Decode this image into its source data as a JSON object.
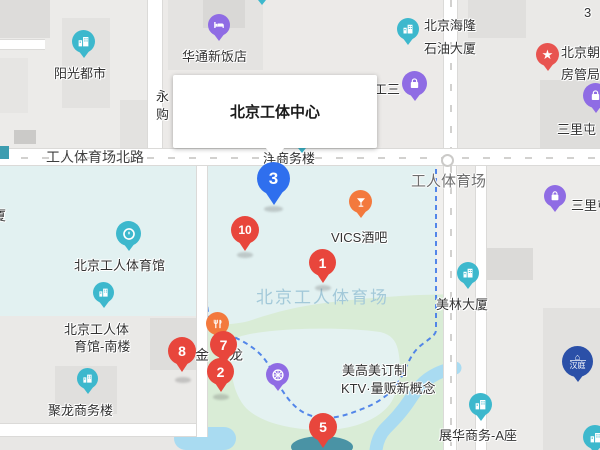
{
  "colors": {
    "teal": "#3db8cd",
    "purple": "#8f6ce4",
    "orange": "#f3793d",
    "red_star": "#e85450",
    "marker_red": "#e8463c",
    "marker_blue": "#2f6fee",
    "dash": "#4a7fe8",
    "water": "#a9dbf1",
    "deep_water": "#3a8aa0",
    "green": "#d9ecd6",
    "cyan_area": "#e2f1f1",
    "area_text": "#a3c9d9",
    "hanting": "#2b50a8"
  },
  "info_box": {
    "title": "北京工体中心"
  },
  "road_labels": {
    "north_road": "工人体育场北路",
    "east_road": "工人体育场"
  },
  "area_label": "北京工人体育场",
  "pois": {
    "yangguang": {
      "label": "阳光都市"
    },
    "huatong": {
      "label": "华通新饭店"
    },
    "hailong": {
      "label_line1": "北京海隆",
      "label_line2": "石油大厦"
    },
    "gongsan": {
      "label": "工三"
    },
    "fangguanju": {
      "label_line1": "北京朝阳",
      "label_line2": "房管局"
    },
    "sanlitun_top": {
      "label": "三里屯"
    },
    "sanlitun_mid": {
      "label": "三里屯"
    },
    "vics": {
      "label": "VICS酒吧"
    },
    "tiyuguan": {
      "label": "北京工人体育馆"
    },
    "nanlou": {
      "label_line1": "北京工人体",
      "label_line2": "育馆-南楼"
    },
    "julong": {
      "label": "聚龙商务楼"
    },
    "meilin": {
      "label": "美林大厦"
    },
    "zhanhua": {
      "label": "展华商务-A座"
    },
    "ktv": {
      "label_line1": "美高美订制",
      "label_line2": "KTV·量贩新概念"
    },
    "yang_office": {
      "label": "洋商务楼"
    },
    "hanting": {
      "label": "汉庭"
    }
  },
  "partial_labels": {
    "yong": "永",
    "gou": "购",
    "sha": "厦",
    "three": "3",
    "jin_left": "金",
    "jin_right": "龙"
  },
  "markers": [
    {
      "number": "1",
      "color": "red"
    },
    {
      "number": "2",
      "color": "red"
    },
    {
      "number": "3",
      "color": "blue"
    },
    {
      "number": "5",
      "color": "red"
    },
    {
      "number": "7",
      "color": "red"
    },
    {
      "number": "8",
      "color": "red"
    },
    {
      "number": "10",
      "color": "red"
    }
  ]
}
